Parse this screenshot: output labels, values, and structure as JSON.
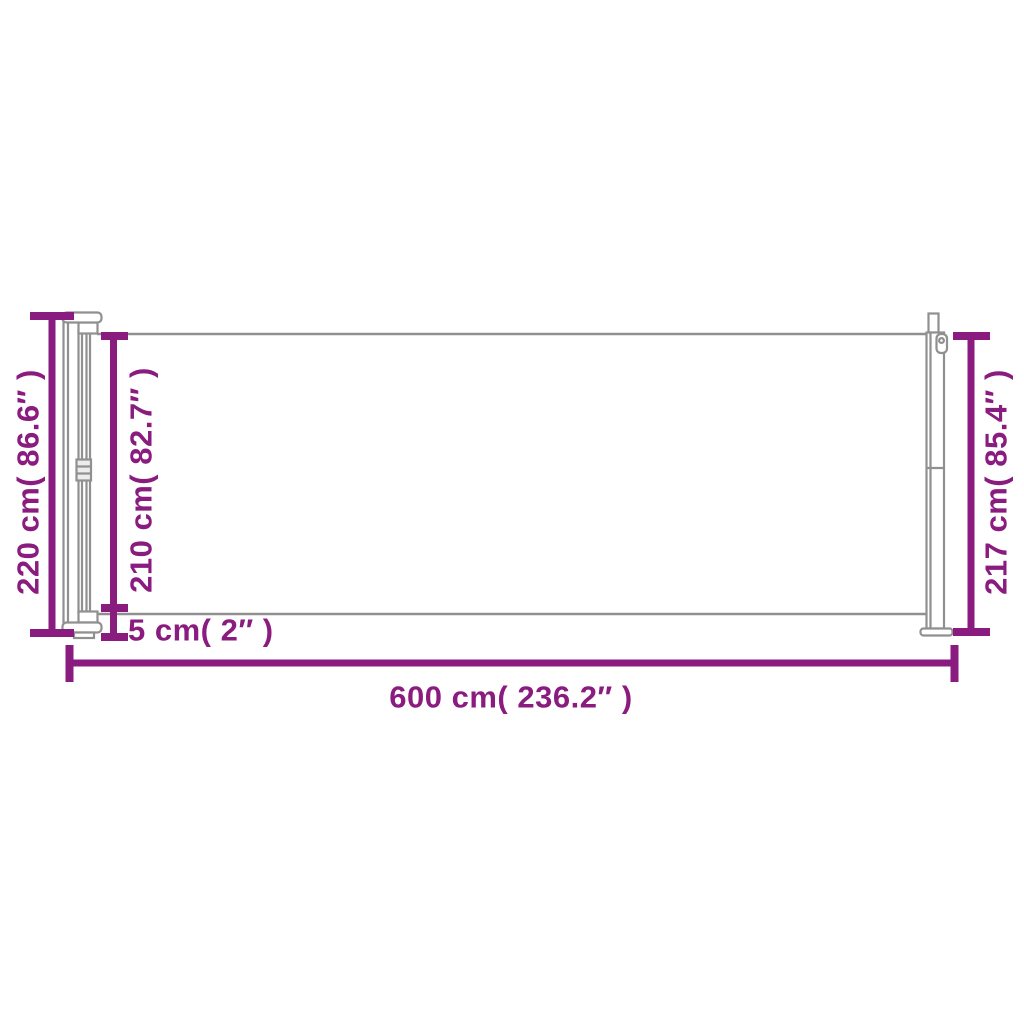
{
  "diagram": {
    "type": "product-dimension-diagram",
    "colors": {
      "dimension": "#8a1b7f",
      "outline": "#909090",
      "background": "#ffffff"
    },
    "labels": {
      "height_total": "220 cm( 86.6″ )",
      "height_fabric": "210 cm( 82.7″ )",
      "gap_bottom": "5 cm( 2″ )",
      "height_right": "217 cm( 85.4″ )",
      "length_total": "600 cm( 236.2″ )"
    },
    "values": {
      "height_total_cm": 220,
      "height_total_in": 86.6,
      "height_fabric_cm": 210,
      "height_fabric_in": 82.7,
      "gap_bottom_cm": 5,
      "gap_bottom_in": 2,
      "height_right_cm": 217,
      "height_right_in": 85.4,
      "length_total_cm": 600,
      "length_total_in": 236.2
    }
  }
}
